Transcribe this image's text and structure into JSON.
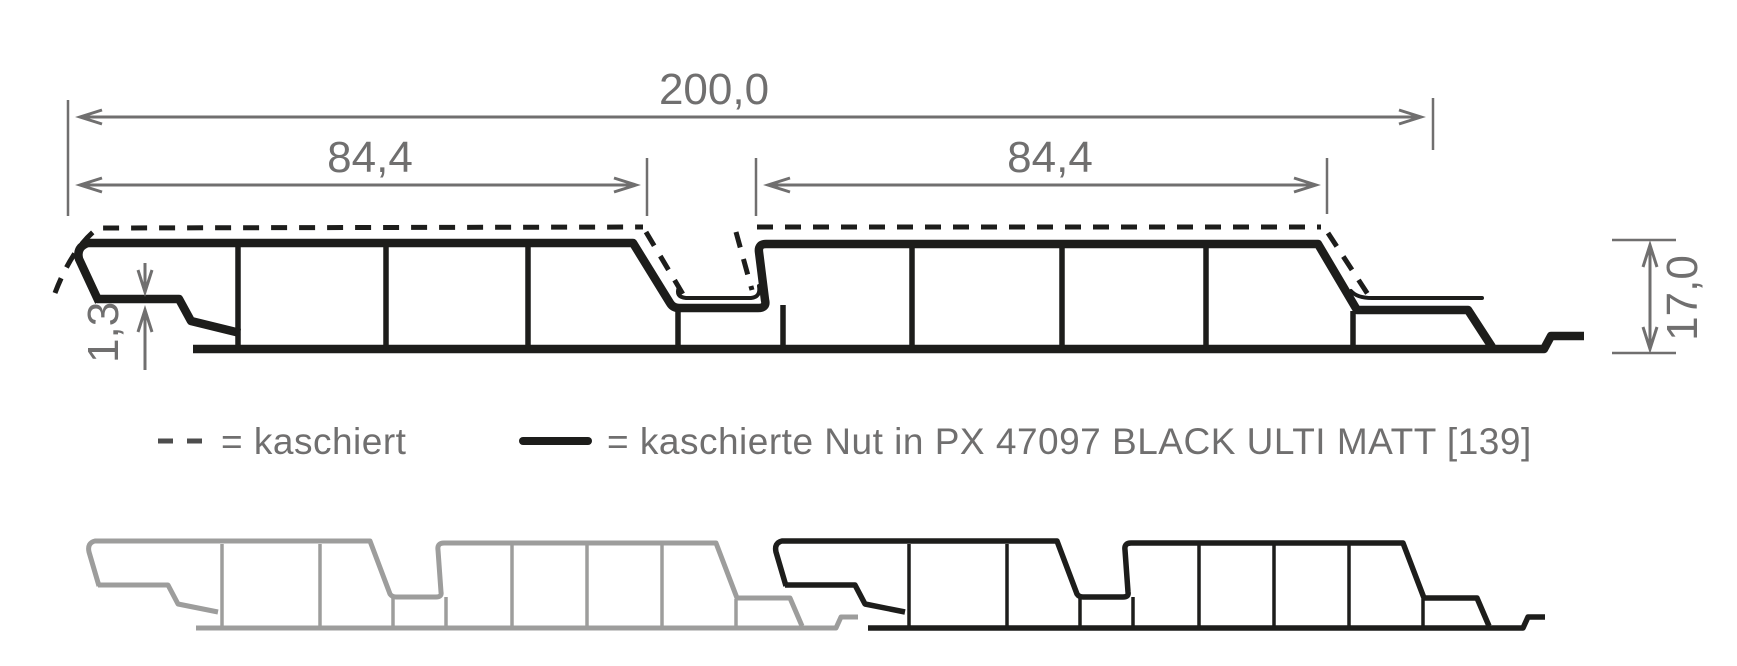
{
  "drawing": {
    "dimensions": {
      "overall_width": "200,0",
      "face_width_left": "84,4",
      "face_width_right": "84,4",
      "profile_height": "17,0",
      "top_wall_thickness": "1,3"
    },
    "legend": {
      "dashed_label": "= kaschiert",
      "solid_label": "= kaschierte Nut in PX 47097 BLACK ULTI MATT [139]"
    },
    "colors": {
      "profile": "#1d1d1b",
      "dim": "#706f6f",
      "panelgray": "#9d9d9c",
      "background": "#ffffff"
    }
  }
}
